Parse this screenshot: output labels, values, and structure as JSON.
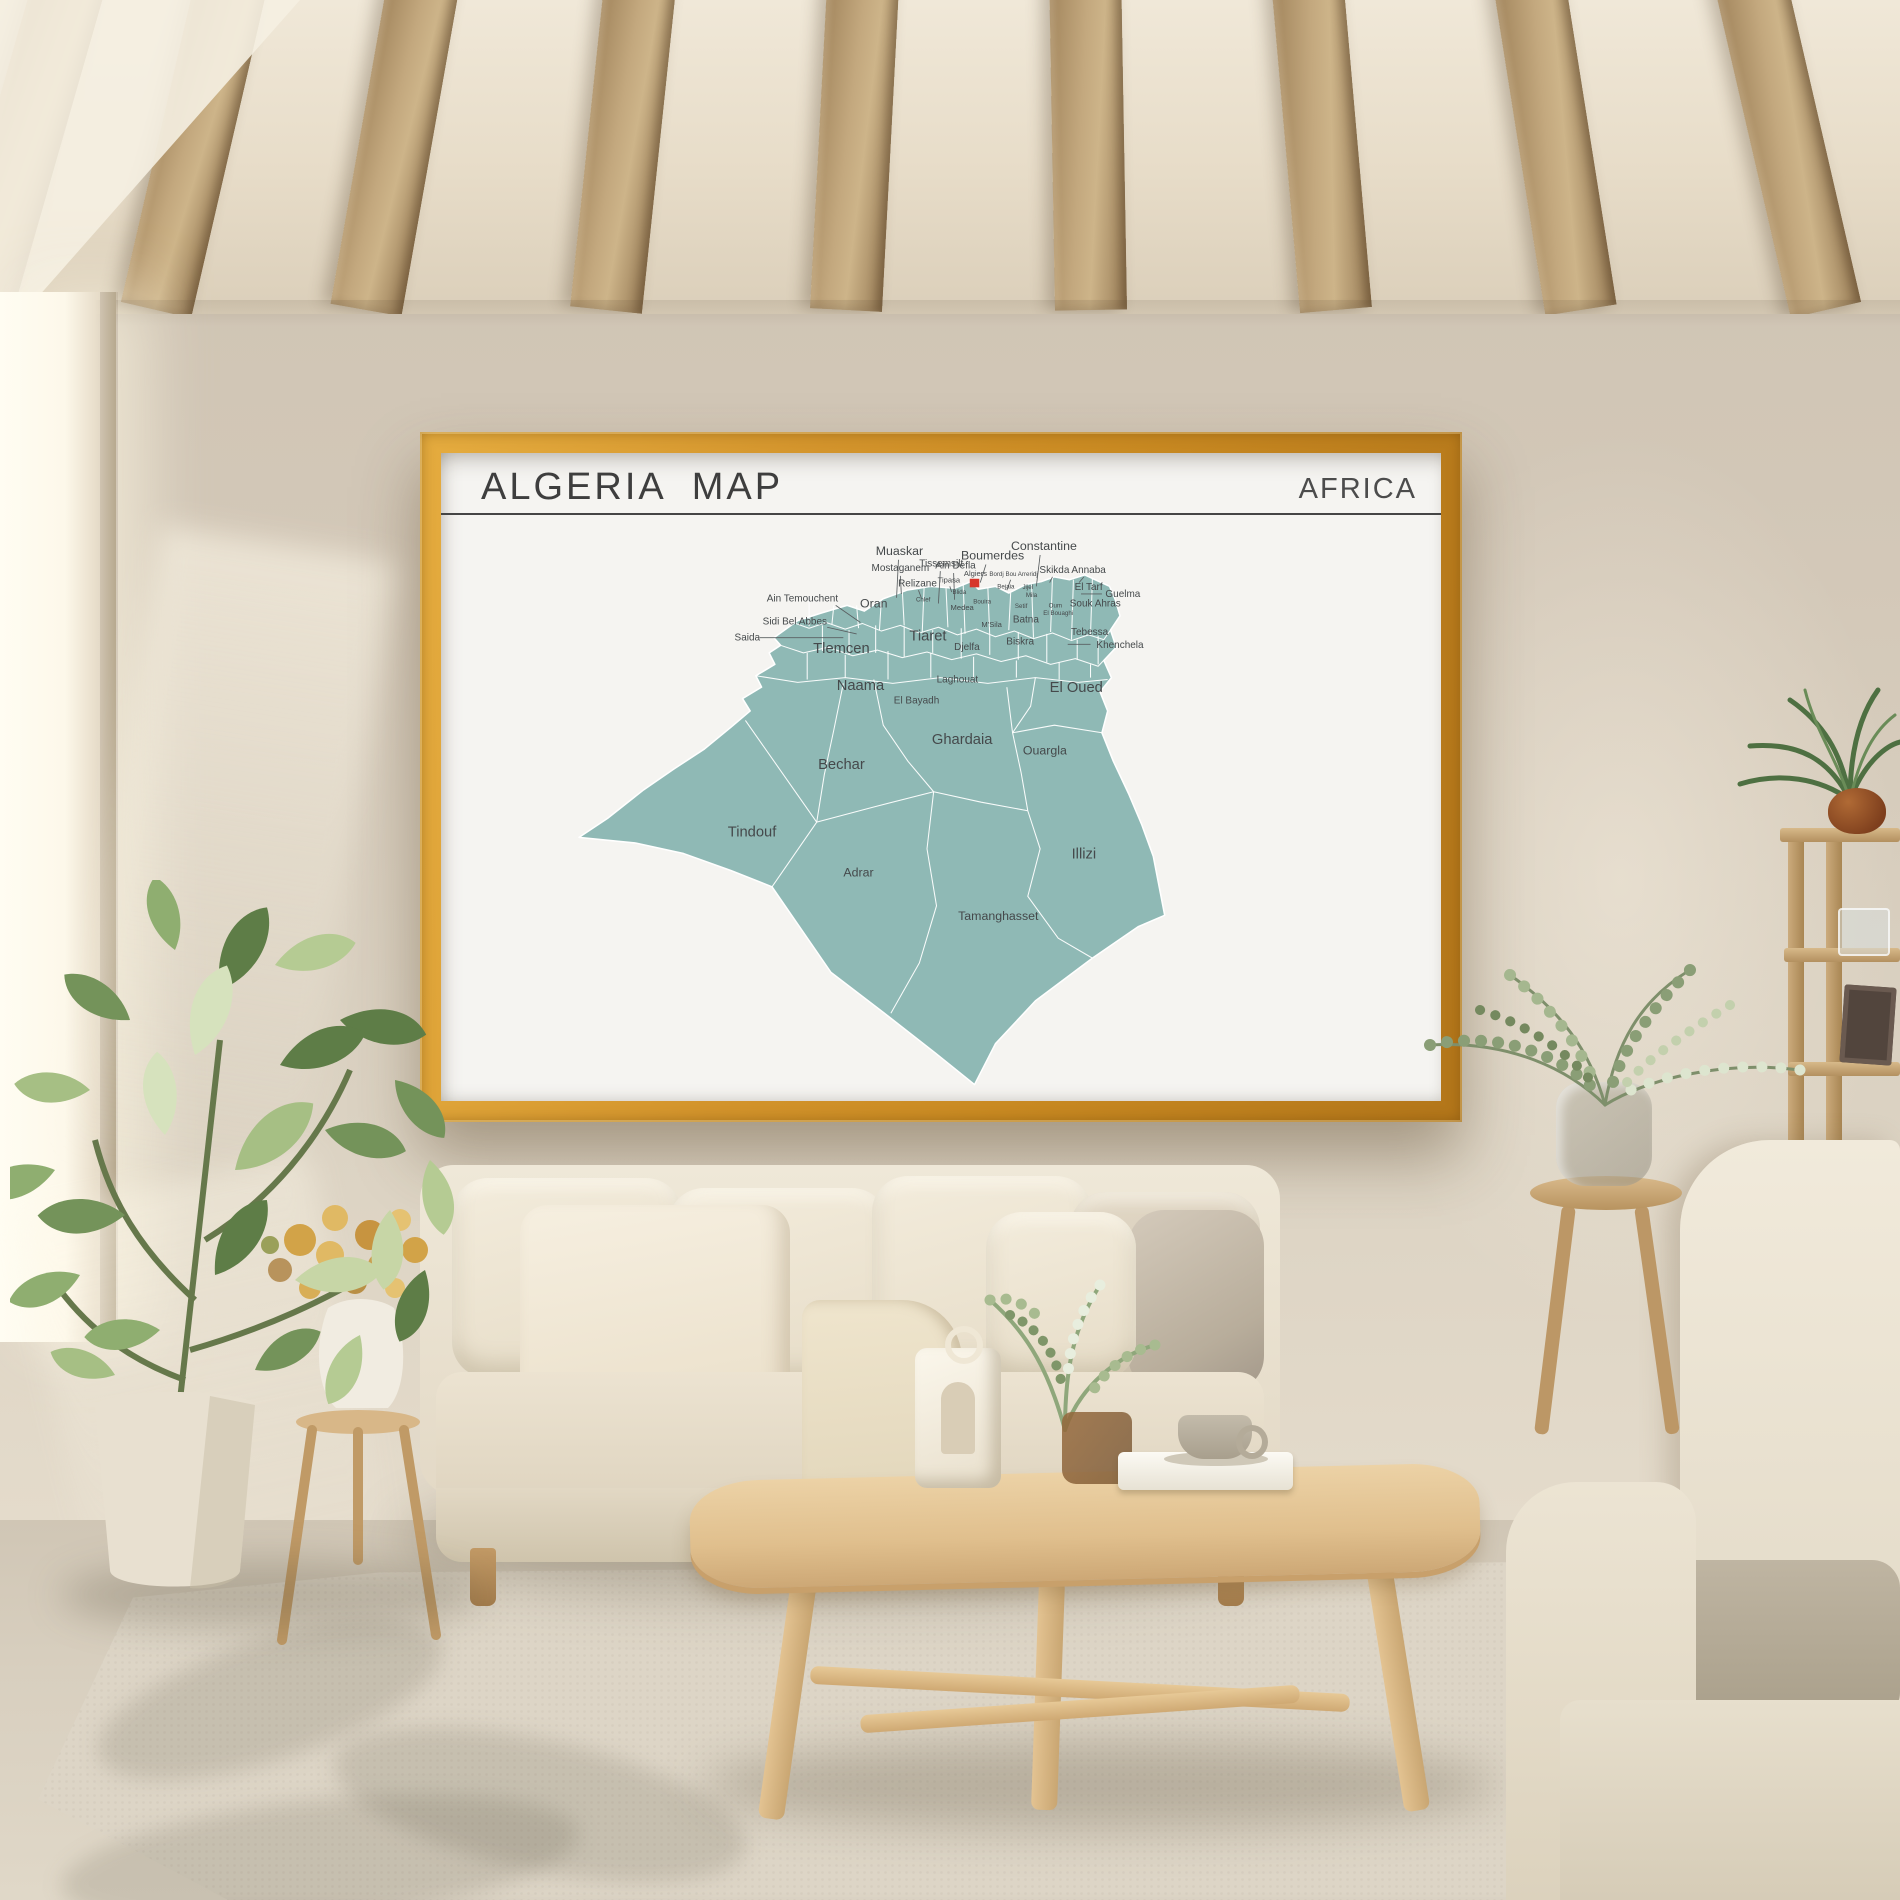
{
  "poster": {
    "title": "ALGERIA  MAP",
    "continent": "AFRICA"
  },
  "map": {
    "colors": {
      "land": "#8FB9B5",
      "border": "#FFFFFF",
      "label": "#45494B",
      "marker": "#D6362B",
      "leader": "#5A5F61"
    },
    "marker": {
      "x": 431,
      "y": 46,
      "w": 10,
      "h": 9
    },
    "labels": [
      {
        "t": "Muaskar",
        "x": 357,
        "y": 21,
        "s": 4,
        "l": [
          356,
          26,
          354,
          66
        ]
      },
      {
        "t": "Tissemsilt",
        "x": 401,
        "y": 33,
        "s": 3,
        "l": [
          400,
          38,
          398,
          72
        ]
      },
      {
        "t": "Mostaganem",
        "x": 358,
        "y": 38,
        "s": 3,
        "l": [
          358,
          43,
          359,
          62
        ]
      },
      {
        "t": "Ain Defla",
        "x": 416,
        "y": 35,
        "s": 3,
        "l": [
          414,
          40,
          415,
          68
        ]
      },
      {
        "t": "Boumerdes",
        "x": 455,
        "y": 26,
        "s": 4,
        "l": [
          448,
          31,
          442,
          50
        ]
      },
      {
        "t": "Relizane",
        "x": 376,
        "y": 54,
        "s": 3,
        "l": [
          377,
          58,
          380,
          66
        ]
      },
      {
        "t": "Tipasa",
        "x": 409,
        "y": 50,
        "s": 2,
        "l": [
          410,
          54,
          412,
          60
        ]
      },
      {
        "t": "Algiers",
        "x": 437,
        "y": 43,
        "s": 2
      },
      {
        "t": "Bordj Bou Arreridj",
        "x": 477,
        "y": 43,
        "s": 1,
        "l": [
          474,
          47,
          470,
          58
        ]
      },
      {
        "t": "Bejaia",
        "x": 469,
        "y": 56,
        "s": 1
      },
      {
        "t": "Jijel",
        "x": 492,
        "y": 57,
        "s": 1
      },
      {
        "t": "Constantine",
        "x": 509,
        "y": 16,
        "s": 4,
        "l": [
          505,
          21,
          501,
          54
        ]
      },
      {
        "t": "Skikda",
        "x": 520,
        "y": 40,
        "s": 3,
        "l": [
          518,
          44,
          515,
          50
        ]
      },
      {
        "t": "Annaba",
        "x": 556,
        "y": 40,
        "s": 3,
        "l": [
          551,
          44,
          546,
          50
        ]
      },
      {
        "t": "El Tarf",
        "x": 556,
        "y": 58,
        "s": 3
      },
      {
        "t": "Guelma",
        "x": 592,
        "y": 65,
        "s": 3,
        "l": [
          570,
          62,
          548,
          62
        ]
      },
      {
        "t": "Souk Ahras",
        "x": 563,
        "y": 75,
        "s": 3
      },
      {
        "t": "Mila",
        "x": 496,
        "y": 65,
        "s": 1
      },
      {
        "t": "Setif",
        "x": 485,
        "y": 77,
        "s": 1
      },
      {
        "t": "Oum",
        "x": 521,
        "y": 76,
        "s": 1
      },
      {
        "t": "El Bouaghi",
        "x": 524,
        "y": 84,
        "s": 1
      },
      {
        "t": "Batna",
        "x": 490,
        "y": 92,
        "s": 3
      },
      {
        "t": "Biskra",
        "x": 484,
        "y": 115,
        "s": 3
      },
      {
        "t": "Tebessa",
        "x": 557,
        "y": 105,
        "s": 3
      },
      {
        "t": "Khenchela",
        "x": 589,
        "y": 119,
        "s": 3,
        "l": [
          558,
          115,
          534,
          115
        ]
      },
      {
        "t": "Ain Temouchent",
        "x": 255,
        "y": 70,
        "s": 3,
        "l": [
          290,
          74,
          316,
          92
        ]
      },
      {
        "t": "Oran",
        "x": 330,
        "y": 76,
        "s": 4
      },
      {
        "t": "Sidi Bel Abbes",
        "x": 247,
        "y": 94,
        "s": 3,
        "l": [
          281,
          97,
          312,
          104
        ]
      },
      {
        "t": "Saida",
        "x": 197,
        "y": 111,
        "s": 3,
        "l": [
          210,
          108,
          298,
          108
        ]
      },
      {
        "t": "Tlemcen",
        "x": 296,
        "y": 124,
        "s": 5
      },
      {
        "t": "Chlef",
        "x": 382,
        "y": 70,
        "s": 1
      },
      {
        "t": "Blida",
        "x": 420,
        "y": 62,
        "s": 1
      },
      {
        "t": "Medea",
        "x": 423,
        "y": 79,
        "s": 2
      },
      {
        "t": "Bouira",
        "x": 444,
        "y": 72,
        "s": 1
      },
      {
        "t": "M'Sila",
        "x": 454,
        "y": 97,
        "s": 2
      },
      {
        "t": "Tiaret",
        "x": 387,
        "y": 111,
        "s": 5
      },
      {
        "t": "Djelfa",
        "x": 428,
        "y": 121,
        "s": 3
      },
      {
        "t": "Naama",
        "x": 316,
        "y": 163,
        "s": 5
      },
      {
        "t": "El Bayadh",
        "x": 375,
        "y": 177,
        "s": 3
      },
      {
        "t": "Laghouat",
        "x": 418,
        "y": 155,
        "s": 3
      },
      {
        "t": "El Oued",
        "x": 543,
        "y": 165,
        "s": 5
      },
      {
        "t": "Ghardaia",
        "x": 423,
        "y": 220,
        "s": 5
      },
      {
        "t": "Ouargla",
        "x": 510,
        "y": 231,
        "s": 4
      },
      {
        "t": "Bechar",
        "x": 296,
        "y": 246,
        "s": 5
      },
      {
        "t": "Tindouf",
        "x": 202,
        "y": 317,
        "s": 5
      },
      {
        "t": "Adrar",
        "x": 314,
        "y": 359,
        "s": 4
      },
      {
        "t": "Illizi",
        "x": 551,
        "y": 340,
        "s": 5
      },
      {
        "t": "Tamanghasset",
        "x": 461,
        "y": 405,
        "s": 4
      }
    ]
  },
  "scene": {
    "colors": {
      "wall": "#D3C8B8",
      "ceiling": "#E7DDCB",
      "beam_wood": "#B3976C",
      "frame_gold": "#CE8F28",
      "poster_paper": "#F5F4F1",
      "floor": "#D0C6B5",
      "rug": "#DDD5C6",
      "sofa_cream": "#ECE4D3",
      "cushion_taupe": "#C9BFAE",
      "table_wood": "#E0BF8D",
      "plant_green": "#74935A",
      "dried_flowers": "#D2A348",
      "pot_cream": "#E8E0D0",
      "clay_pot": "#8A4A26"
    }
  }
}
